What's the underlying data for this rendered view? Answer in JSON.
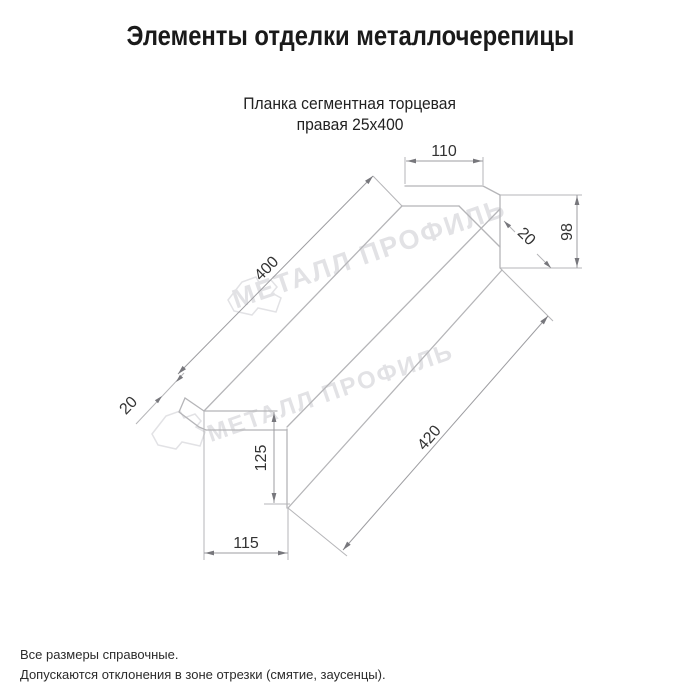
{
  "page": {
    "title": "Элементы отделки металлочерепицы"
  },
  "product": {
    "name_line1": "Планка сегментная торцевая",
    "name_line2": "правая 25х400"
  },
  "drawing": {
    "dimensions": {
      "top_flange_width": "110",
      "right_end_height": "98",
      "right_end_fold": "20",
      "top_edge_length": "400",
      "bottom_edge_length": "420",
      "left_end_fold": "20",
      "left_end_height": "125",
      "bottom_width": "115"
    },
    "watermark_text": "МЕТАЛЛ ПРОФИЛЬ"
  },
  "footnotes": {
    "line1": "Все размеры справочные.",
    "line2": "Допускаются отклонения в зоне отрезки (смятие, заусенцы)."
  },
  "colors": {
    "line": "#b5b5b8",
    "dim_line": "#9c9ca0",
    "arrow": "#77777c",
    "dim_text": "#333333",
    "watermark": "#e2e2e5",
    "title_text": "#1a1a1a"
  }
}
